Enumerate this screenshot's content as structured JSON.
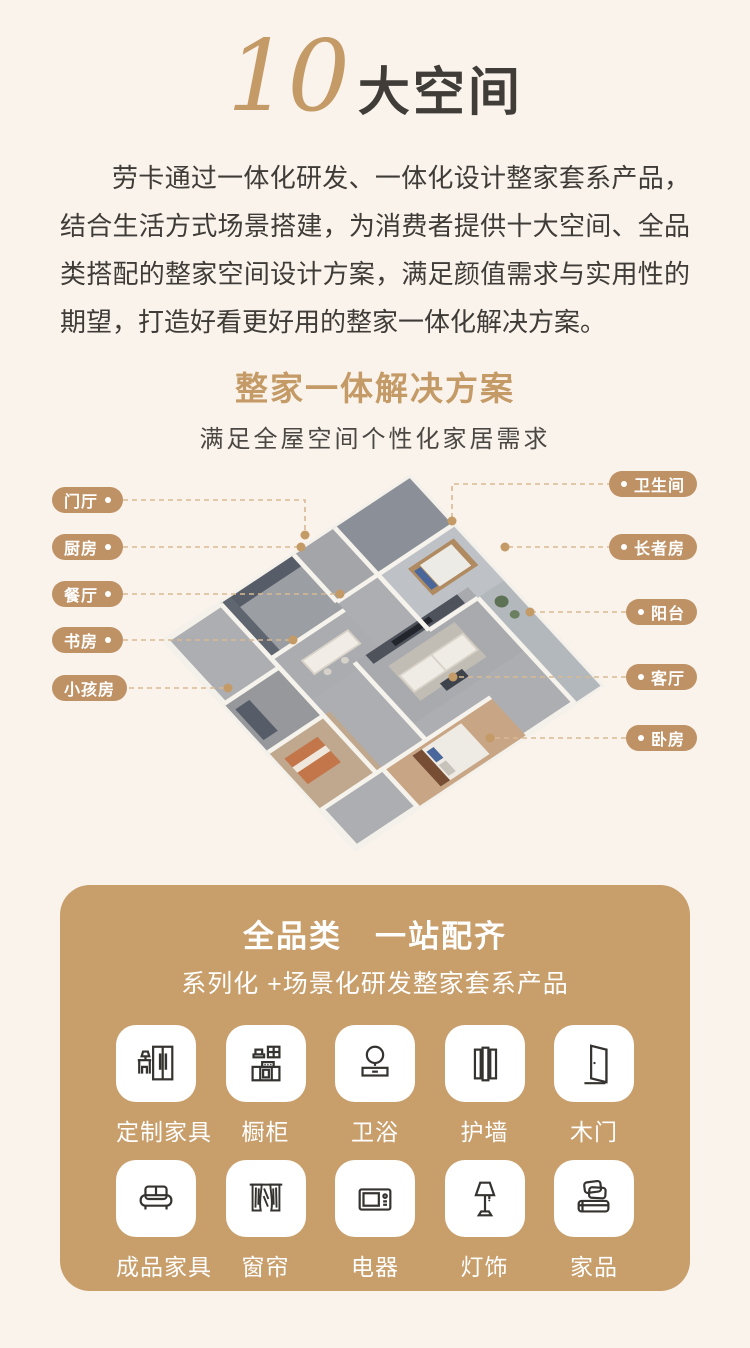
{
  "hero": {
    "number": "10",
    "title": "大空间"
  },
  "intro": {
    "text": "劳卡通过一体化研发、一体化设计整家套系产品，结合生活方式场景搭建，为消费者提供十大空间、全品类搭配的整家空间设计方案，满足颜值需求与实用性的期望，打造好看更好用的整家一体化解决方案。"
  },
  "solution": {
    "title": "整家一体解决方案",
    "subtitle": "满足全屋空间个性化家居需求",
    "left_labels": [
      {
        "text": "门厅"
      },
      {
        "text": "厨房"
      },
      {
        "text": "餐厅"
      },
      {
        "text": "书房"
      },
      {
        "text": "小孩房"
      }
    ],
    "right_labels": [
      {
        "text": "卫生间"
      },
      {
        "text": "长者房"
      },
      {
        "text": "阳台"
      },
      {
        "text": "客厅"
      },
      {
        "text": "卧房"
      }
    ]
  },
  "products": {
    "title": "全品类　一站配齐",
    "subtitle": "系列化 +场景化研发整家套系产品",
    "items": [
      {
        "label": "定制家具",
        "icon": "wardrobe-icon"
      },
      {
        "label": "橱柜",
        "icon": "kitchen-cabinet-icon"
      },
      {
        "label": "卫浴",
        "icon": "bath-icon"
      },
      {
        "label": "护墙",
        "icon": "wall-panel-icon"
      },
      {
        "label": "木门",
        "icon": "door-icon"
      },
      {
        "label": "成品家具",
        "icon": "sofa-icon"
      },
      {
        "label": "窗帘",
        "icon": "curtain-icon"
      },
      {
        "label": "电器",
        "icon": "appliance-icon"
      },
      {
        "label": "灯饰",
        "icon": "lamp-icon"
      },
      {
        "label": "家品",
        "icon": "bedding-icon"
      }
    ]
  },
  "colors": {
    "background": "#faf3ec",
    "gold": "#c49a66",
    "card_gold": "#c89e6b",
    "pill_gold": "#bf9266",
    "text_dark": "#3f3b37",
    "dashed_line": "#d8b992",
    "icon_stroke": "#35332f"
  }
}
